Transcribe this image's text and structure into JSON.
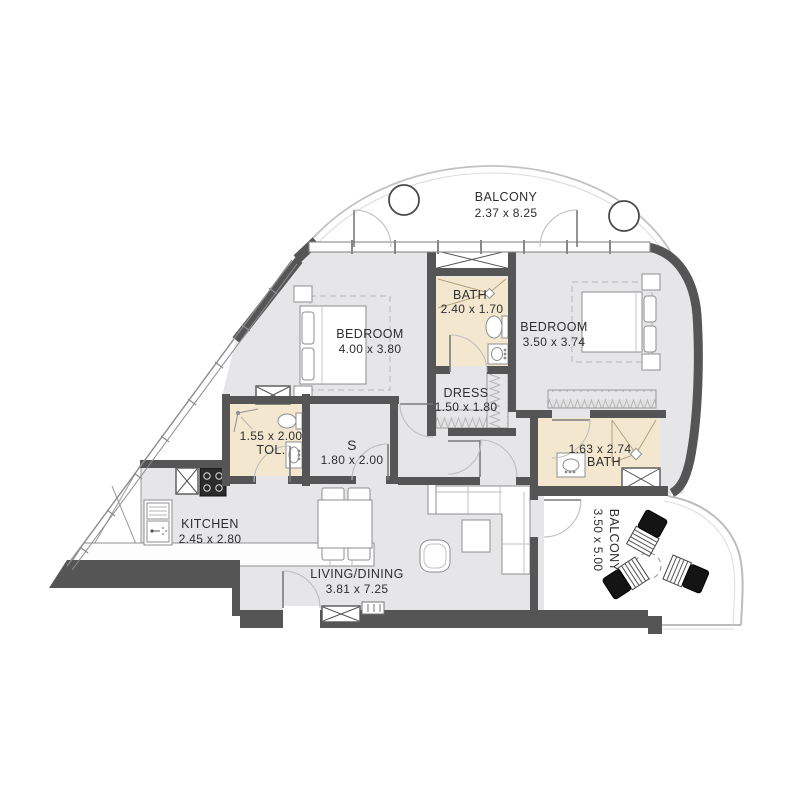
{
  "plan_title": "Apartment floor plan",
  "colors": {
    "wall": "#555555",
    "floor": "#e6e6e8",
    "wet_floor": "#f3e8cf",
    "furniture_line": "#8f8f8f",
    "balcony_line": "#c2c2c2",
    "hatch_line": "#b5b5b5",
    "text": "#2e2e2e",
    "chair_cushion": "#141414"
  },
  "rooms": [
    {
      "id": "balcony-top",
      "name": "BALCONY",
      "dims": "2.37 x 8.25"
    },
    {
      "id": "bedroom-left",
      "name": "BEDROOM",
      "dims": "4.00 x 3.80"
    },
    {
      "id": "bath-center",
      "name": "BATH",
      "dims": "2.40 x 1.70"
    },
    {
      "id": "bedroom-right",
      "name": "BEDROOM",
      "dims": "3.50 x 3.74"
    },
    {
      "id": "dress",
      "name": "DRESS",
      "dims": "1.50 x 1.80"
    },
    {
      "id": "toilet",
      "name": "TOL.",
      "dims": "1.55 x 2.00"
    },
    {
      "id": "store",
      "name": "S",
      "dims": "1.80 x 2.00"
    },
    {
      "id": "bath-right",
      "name": "BATH",
      "dims": "1.63 x 2.74"
    },
    {
      "id": "kitchen",
      "name": "KITCHEN",
      "dims": "2.45 x 2.80"
    },
    {
      "id": "living",
      "name": "LIVING/DINING",
      "dims": "3.81 x 7.25"
    },
    {
      "id": "balcony-right",
      "name": "BALCONY",
      "dims": "3.50 x 5.00"
    }
  ]
}
